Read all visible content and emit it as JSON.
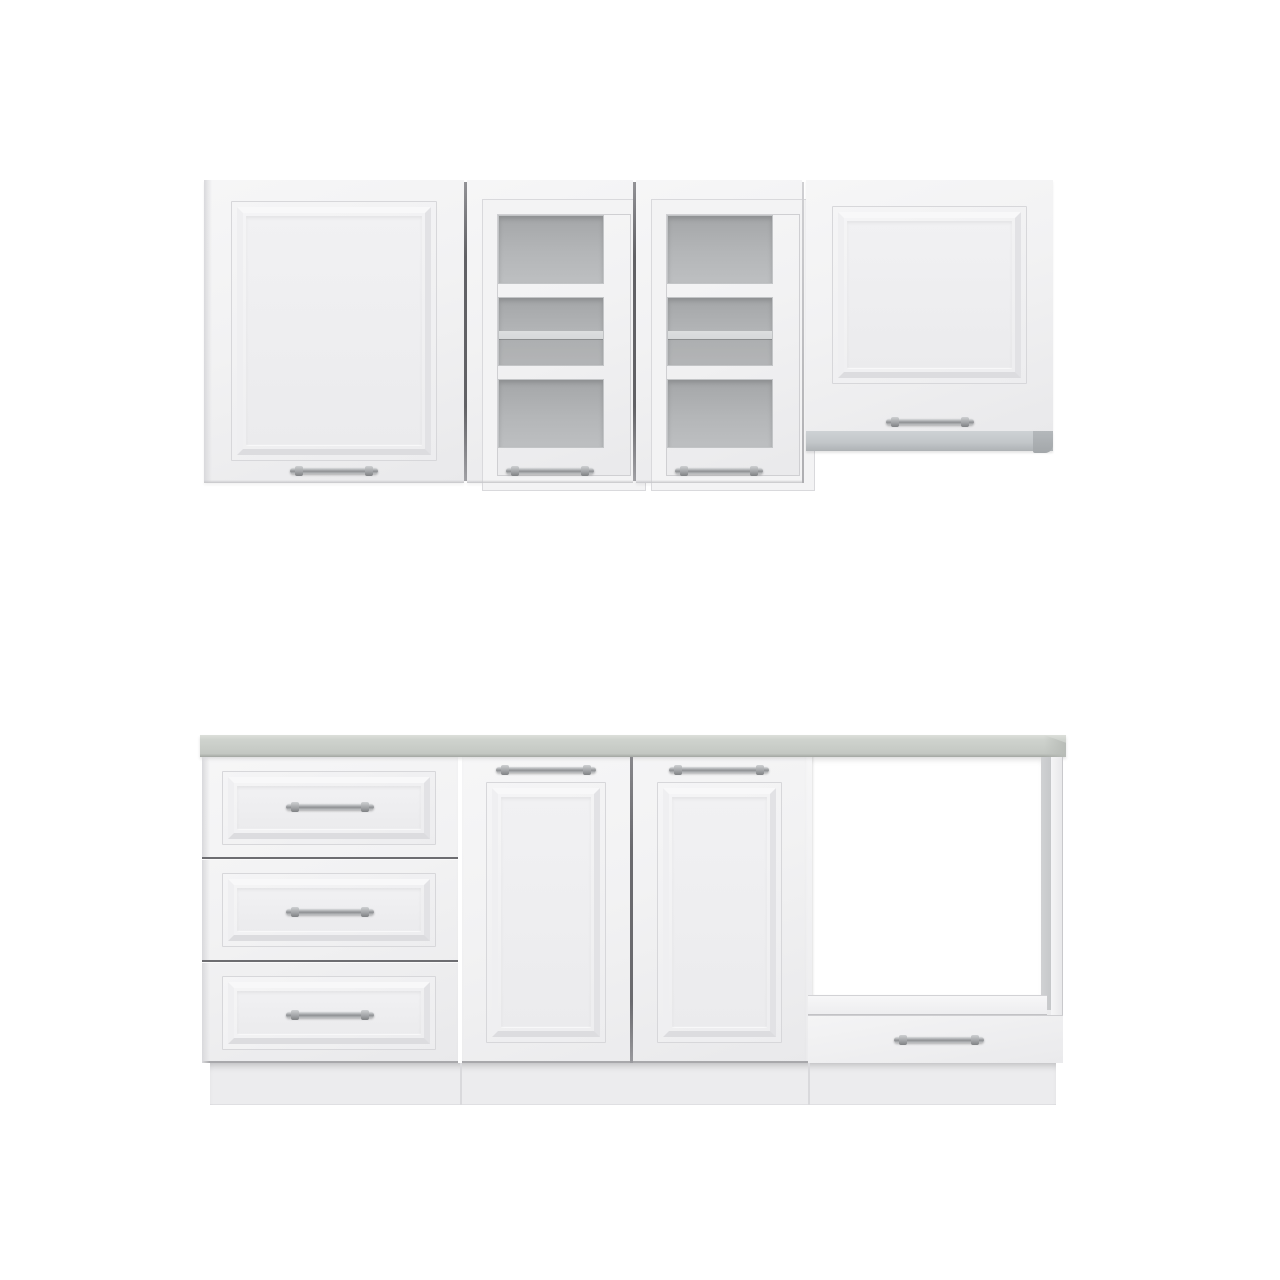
{
  "scene": {
    "subject": "White modular kitchen cabinet set with classic framed fronts, shown as wall row and base row on a white background",
    "background": "#ffffff",
    "rows": {
      "wall": {
        "name": "wall-cabinet-row",
        "cabinets": [
          {
            "id": "wall-solid",
            "style": "framed solid door",
            "handle": "metal rail, bottom center"
          },
          {
            "id": "wall-glass-left",
            "style": "glass door with frosted panes",
            "panes": 3,
            "shelf_behind_pane": 2,
            "handle": "metal rail, bottom center"
          },
          {
            "id": "wall-glass-right",
            "style": "glass door with frosted panes",
            "panes": 3,
            "shelf_behind_pane": 2,
            "handle": "metal rail, bottom center"
          },
          {
            "id": "wall-lift-up",
            "style": "framed lift-up door with aluminum trim strip below",
            "handle": "metal rail, bottom center"
          }
        ]
      },
      "base": {
        "name": "base-cabinet-row",
        "worktop": "light grey laminate worktop",
        "cabinets": [
          {
            "id": "base-drawers",
            "style": "drawer unit",
            "drawers": 3,
            "handle": "metal rail, centered"
          },
          {
            "id": "base-door-left",
            "style": "framed door",
            "handle": "metal rail, top center"
          },
          {
            "id": "base-door-right",
            "style": "framed door",
            "handle": "metal rail, top center"
          },
          {
            "id": "base-oven-housing",
            "style": "open oven niche with drawer below",
            "drawers": 1,
            "handle": "metal rail, centered"
          }
        ],
        "plinth": true
      }
    },
    "colors": {
      "front": "#f2f2f3",
      "front_deep": "#e9e9eb",
      "edge": "#d7d7da",
      "seam": "#626266",
      "glass_top": "#a4a6a8",
      "glass_bottom": "#bdbfc1",
      "glass_shelf": "#d6d8d9",
      "worktop": "#c9cdc8",
      "worktop_hi": "#dcdfda",
      "worktop_edge": "#a2a6a1",
      "hood": "#c3c7ca",
      "hood_cap": "#a3a7aa",
      "handle_hi": "#d9dbdd",
      "handle_lo": "#8f9194",
      "plinth": "#ececee",
      "niche_shade": "#c6c8ca"
    }
  }
}
